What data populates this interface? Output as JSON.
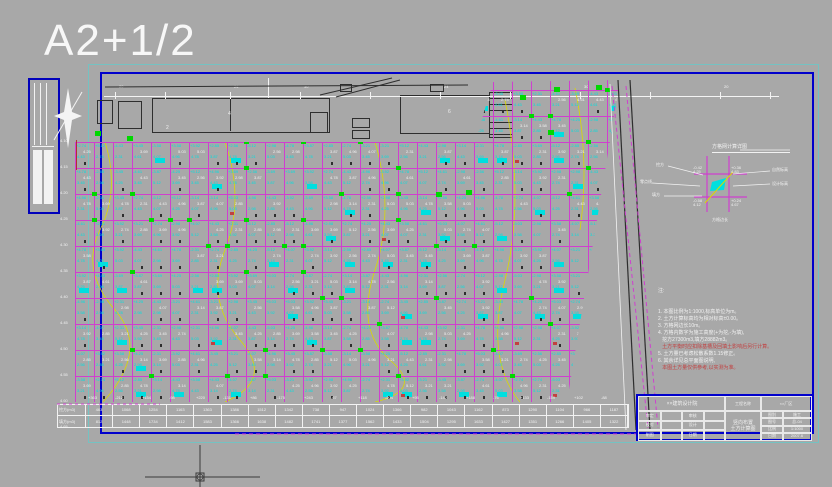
{
  "sheet": {
    "label": "A2+1/2"
  },
  "palette": {
    "background": "#a8a8a8",
    "frame_blue": "#0000cc",
    "frame_teal": "#74c2c2",
    "grid_magenta": "#cf3fcf",
    "elev_cyan": "#00dfdf",
    "marker_green": "#00d800",
    "contour_yellow": "#d9d900",
    "ink_dark": "#2e2e2e",
    "text_white": "#f2f2f2",
    "warn_red": "#c24040"
  },
  "strip_labels": [
    "4",
    "2",
    "6"
  ],
  "dim_labels": [
    "20",
    "24",
    "30",
    "24",
    "30",
    "20"
  ],
  "grid": {
    "cols": 30,
    "rows": 12,
    "value_pool": [
      "4.25",
      "3.87",
      "2.56",
      "5.12",
      "3.14",
      "4.61",
      "2.98",
      "3.45",
      "5.03",
      "4.78",
      "2.31",
      "3.92",
      "4.07",
      "2.74",
      "3.58",
      "4.96",
      "3.21",
      "2.85",
      "4.43",
      "3.69"
    ],
    "row_labels": [
      "4.10",
      "4.15",
      "4.20",
      "4.25",
      "4.30",
      "4.35",
      "4.40",
      "4.45",
      "4.50",
      "4.55",
      "4.60",
      "4.65"
    ]
  },
  "bottom_table": {
    "rows": [
      {
        "label": "挖方(m3)",
        "values": [
          "463",
          "1068",
          "1254",
          "1163",
          "1363",
          "1386",
          "1512",
          "1342",
          "738",
          "947",
          "1024",
          "1366",
          "982",
          "1043",
          "1162",
          "873",
          "1290",
          "1104",
          "966",
          "1187"
        ]
      },
      {
        "label": "填方(m3)",
        "values": [
          "812",
          "1448",
          "1734",
          "1412",
          "1583",
          "1366",
          "1638",
          "1482",
          "1741",
          "1377",
          "1562",
          "1433",
          "1504",
          "1295",
          "1633",
          "1427",
          "1351",
          "1266",
          "1405",
          "1322"
        ]
      }
    ],
    "header_values": [
      "+363",
      "-212",
      "+154",
      "-98",
      "+220",
      "-131",
      "+86",
      "-175",
      "+243",
      "-67",
      "+118",
      "-204",
      "+95",
      "-142",
      "+188",
      "-76",
      "+133",
      "-159",
      "+102",
      "-88"
    ]
  },
  "detail": {
    "title": "方格网计算详图",
    "labels": {
      "left_top": "挖方",
      "left_mid": "零点线",
      "left_bot": "填方",
      "right_top": "自然标高",
      "right_bot": "设计标高",
      "bottom": "方格边长"
    },
    "corners": [
      "-0.42\n4.25",
      "+0.36\n4.83",
      "-0.58\n4.12",
      "+0.24\n4.67"
    ]
  },
  "notes": {
    "heading": "注:",
    "items": [
      {
        "text": "1. 本图比例为1:1000,标高单位为m。",
        "red": false
      },
      {
        "text": "2. 土方计算标高均为相对标高±0.00。",
        "red": false
      },
      {
        "text": "3. 方格网边长10m。",
        "red": false
      },
      {
        "text": "4. 方格内数字为施工高度(+为挖,-为填),",
        "red": false
      },
      {
        "text": "   挖方27300m3,填方28882m3。",
        "red": false
      },
      {
        "text": "   土方平衡时应扣除基槽及回填土影响后另行计算。",
        "red": true
      },
      {
        "text": "5. 土方量已考虑松散系数1.15修正。",
        "red": false
      },
      {
        "text": "6. 其余详见总平面图说明,",
        "red": false
      },
      {
        "text": "   本图土方量仅供参考,以实测为准。",
        "red": true
      }
    ]
  },
  "title_block": {
    "company": "××建筑设计院",
    "project_label": "工程名称",
    "project": "××厂区",
    "drawing_title_1": "竖向布置",
    "drawing_title_2": "土方计算图",
    "sign_rows": [
      [
        "审定",
        "",
        "审核",
        ""
      ],
      [
        "校对",
        "",
        "设计",
        ""
      ],
      [
        "制图",
        "",
        "日期",
        ""
      ]
    ],
    "fields": [
      {
        "label": "图别",
        "value": "施工"
      },
      {
        "label": "图号",
        "value": "总-04"
      },
      {
        "label": "比例",
        "value": "1:1000"
      },
      {
        "label": "日期",
        "value": "2007.6"
      }
    ]
  }
}
